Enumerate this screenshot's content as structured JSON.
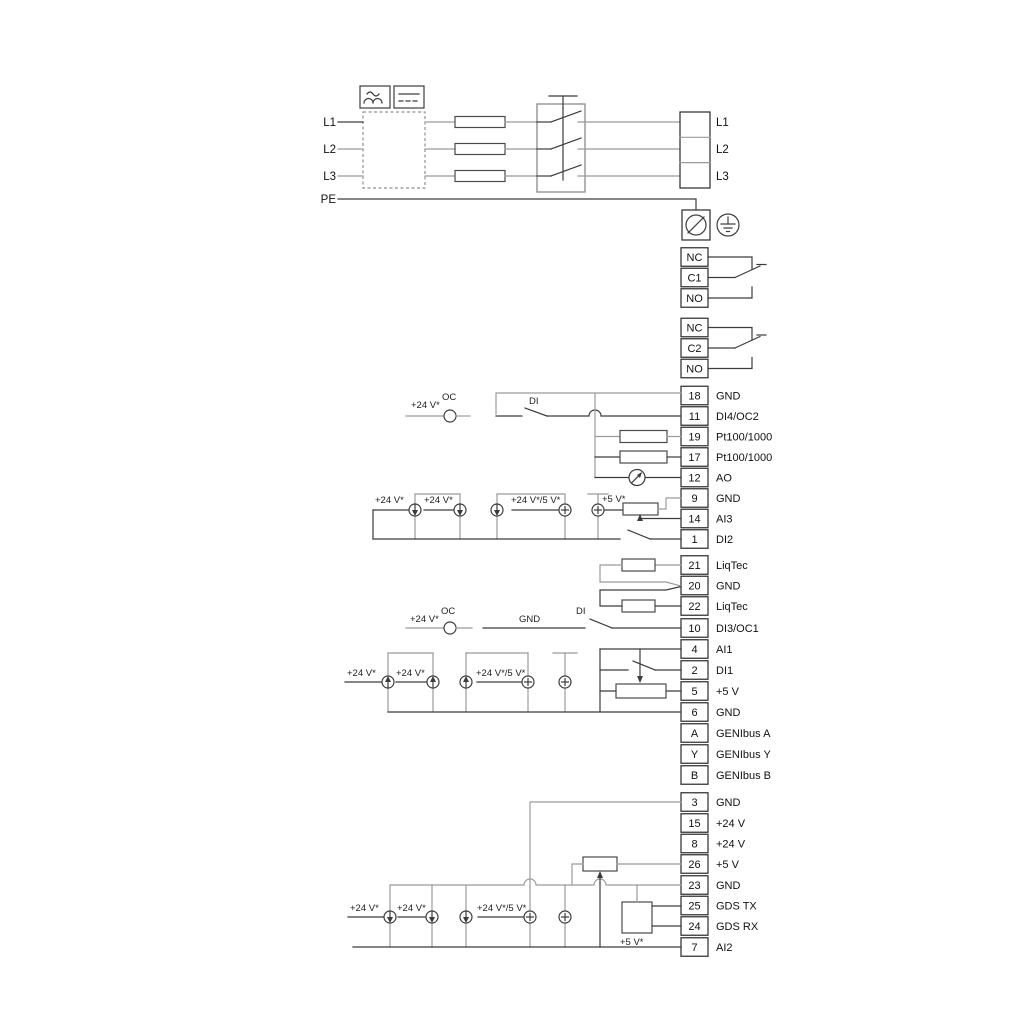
{
  "colors": {
    "wire_dark": "#3c3c3c",
    "wire_gray": "#9b9b9b",
    "text": "#111111",
    "background": "#ffffff"
  },
  "power": {
    "left_labels": [
      "L1",
      "L2",
      "L3"
    ],
    "pe_label": "PE",
    "right_labels": [
      "L1",
      "L2",
      "L3"
    ]
  },
  "relay1": [
    {
      "n": "NC"
    },
    {
      "n": "C1"
    },
    {
      "n": "NO"
    }
  ],
  "relay2": [
    {
      "n": "NC"
    },
    {
      "n": "C2"
    },
    {
      "n": "NO"
    }
  ],
  "strip1": [
    {
      "n": "18",
      "l": "GND"
    },
    {
      "n": "11",
      "l": "DI4/OC2"
    },
    {
      "n": "19",
      "l": "Pt100/1000"
    },
    {
      "n": "17",
      "l": "Pt100/1000"
    },
    {
      "n": "12",
      "l": "AO"
    },
    {
      "n": "9",
      "l": "GND"
    },
    {
      "n": "14",
      "l": "AI3"
    },
    {
      "n": "1",
      "l": "DI2"
    }
  ],
  "liqtec": [
    {
      "n": "21",
      "l": "LiqTec"
    },
    {
      "n": "20",
      "l": "GND"
    },
    {
      "n": "22",
      "l": "LiqTec"
    }
  ],
  "strip2": [
    {
      "n": "10",
      "l": "DI3/OC1"
    },
    {
      "n": "4",
      "l": "AI1"
    },
    {
      "n": "2",
      "l": "DI1"
    },
    {
      "n": "5",
      "l": "+5 V"
    },
    {
      "n": "6",
      "l": "GND"
    },
    {
      "n": "A",
      "l": "GENIbus A"
    },
    {
      "n": "Y",
      "l": "GENIbus Y"
    },
    {
      "n": "B",
      "l": "GENIbus B"
    }
  ],
  "strip3": [
    {
      "n": "3",
      "l": "GND"
    },
    {
      "n": "15",
      "l": "+24 V"
    },
    {
      "n": "8",
      "l": "+24 V"
    },
    {
      "n": "26",
      "l": "+5 V"
    },
    {
      "n": "23",
      "l": "GND"
    },
    {
      "n": "25",
      "l": "GDS TX"
    },
    {
      "n": "24",
      "l": "GDS RX"
    },
    {
      "n": "7",
      "l": "AI2"
    }
  ],
  "ann": {
    "plus24": "+24 V*",
    "plus24_5": "+24 V*/5 V*",
    "plus5": "+5 V*",
    "oc": "OC",
    "di": "DI",
    "gnd": "GND"
  }
}
